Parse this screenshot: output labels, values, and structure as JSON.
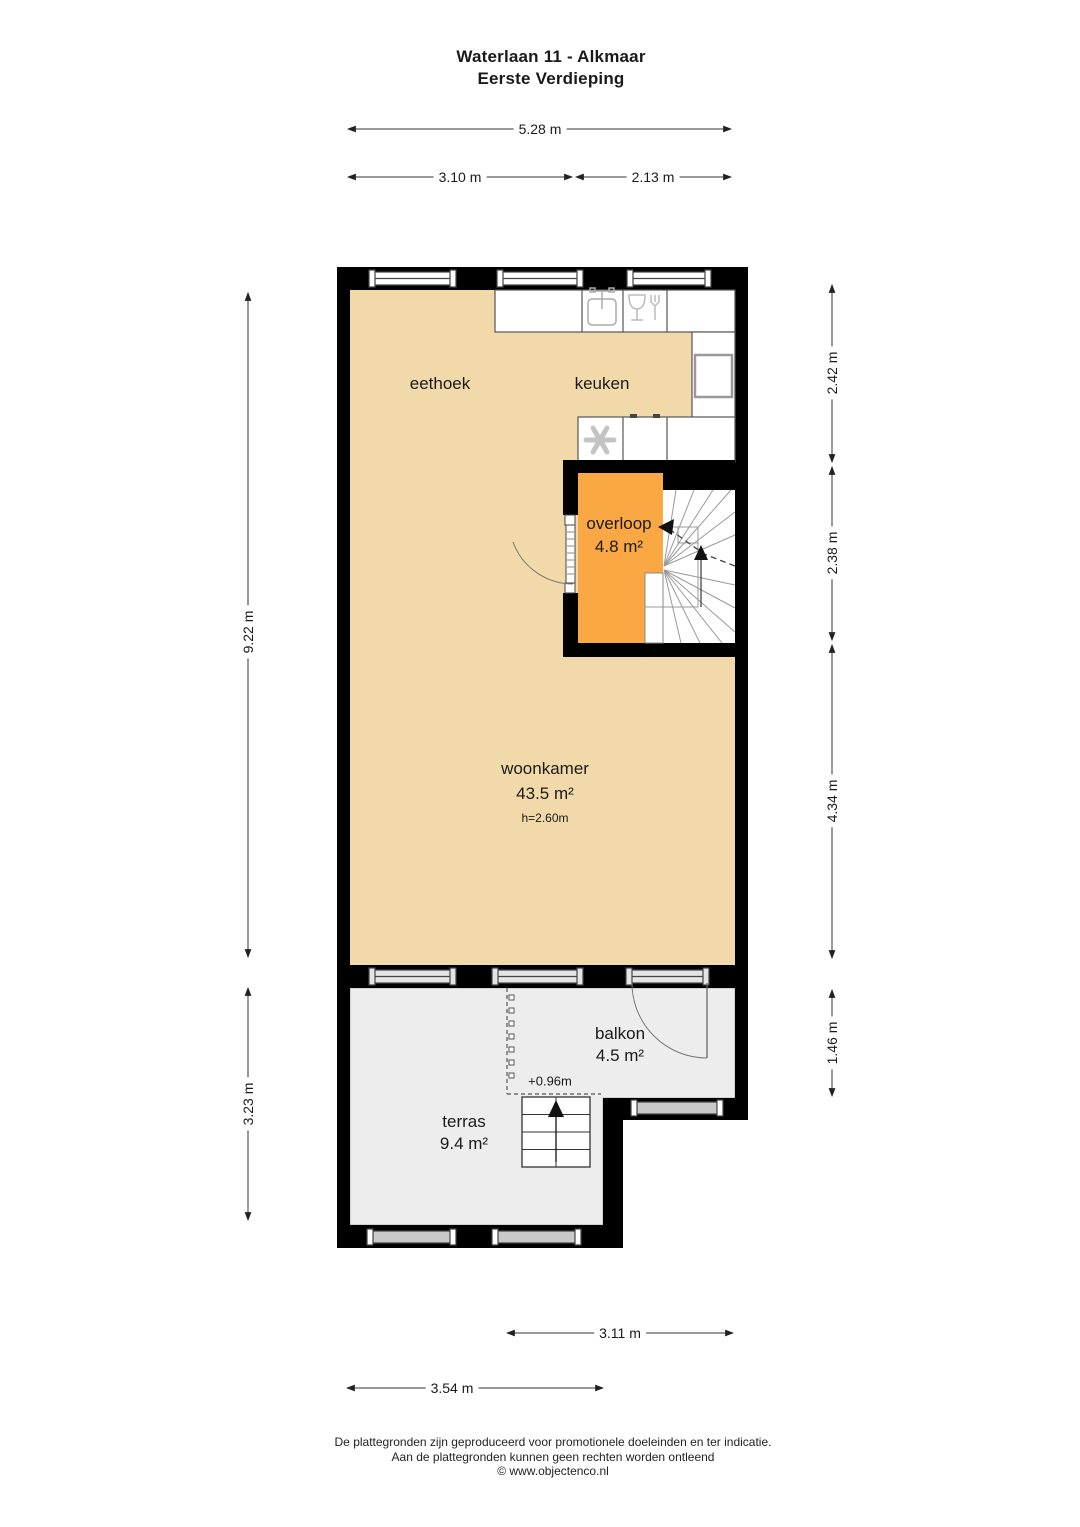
{
  "title": {
    "line1": "Waterlaan 11 - Alkmaar",
    "line2": "Eerste Verdieping"
  },
  "rooms": {
    "eethoek": {
      "name": "eethoek"
    },
    "keuken": {
      "name": "keuken"
    },
    "overloop": {
      "name": "overloop",
      "area": "4.8 m²"
    },
    "woonkamer": {
      "name": "woonkamer",
      "area": "43.5 m²",
      "ceiling_height": "h=2.60m"
    },
    "balkon": {
      "name": "balkon",
      "area": "4.5 m²"
    },
    "terras": {
      "name": "terras",
      "area": "9.4 m²",
      "level": "+0.96m"
    }
  },
  "dimensions": {
    "top_total": "5.28 m",
    "top_left": "3.10 m",
    "top_right": "2.13 m",
    "left_upper": "9.22 m",
    "left_lower": "3.23 m",
    "right_top": "2.42 m",
    "right_mid": "2.38 m",
    "right_lower": "4.34 m",
    "right_bottom": "1.46 m",
    "bottom_inner": "3.11 m",
    "bottom_outer": "3.54 m"
  },
  "icons": {
    "sink": "sink-icon",
    "dishwasher": "dishwasher-icon",
    "freezer": "snowflake-icon",
    "main_stairs": "winder-stairs",
    "terras_stairs": "up-arrow-stairs"
  },
  "colors": {
    "floor_indoor": "#f2d9a9",
    "floor_landing": "#f9a843",
    "floor_outdoor": "#ededed",
    "wall": "#000000"
  },
  "footer": {
    "line1": "De plattegronden zijn geproduceerd voor promotionele doeleinden en ter indicatie.",
    "line2": "Aan de plattegronden kunnen geen rechten worden ontleend",
    "line3": "© www.objectenco.nl"
  }
}
